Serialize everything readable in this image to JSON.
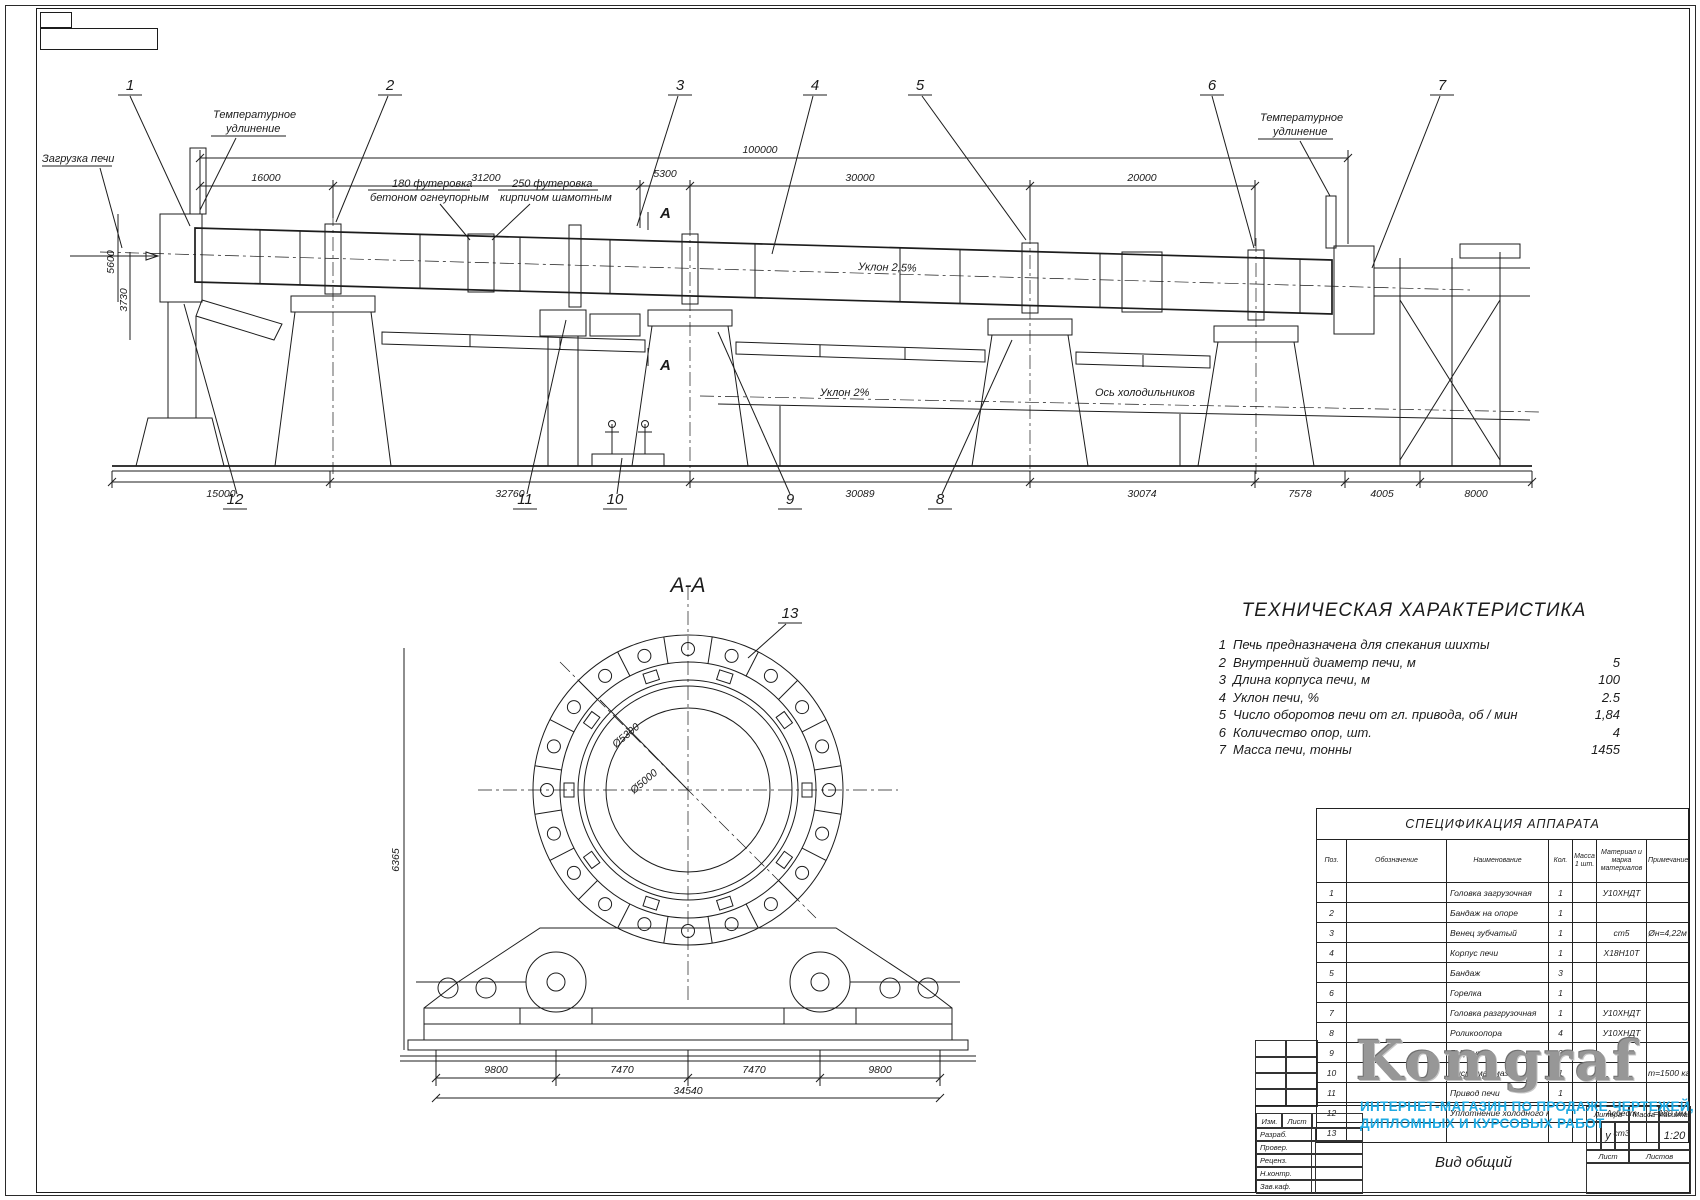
{
  "page": {
    "bg": "#ffffff",
    "line_color": "#1c1c1c"
  },
  "drawing": {
    "labels": {
      "zagruzka": "Загрузка печи",
      "temp1": "Температурное",
      "temp2": "удлинение",
      "f180a": "180 футеровка",
      "f180b": "бетоном огнеупорным",
      "f250a": "250 футеровка",
      "f250b": "кирпичом шамотным",
      "uklon_shell": "Уклон 2,5%",
      "uklon2": "Уклон 2%",
      "os_holod": "Ось холодильников",
      "sec": "А",
      "sec_title": "А-А"
    },
    "balloons": {
      "b1": "1",
      "b2": "2",
      "b3": "3",
      "b4": "4",
      "b5": "5",
      "b6": "6",
      "b7": "7",
      "b8": "8",
      "b9": "9",
      "b10": "10",
      "b11": "11",
      "b12": "12",
      "b13": "13"
    },
    "dims": {
      "top_total": "100000",
      "t1": "16000",
      "t2": "31200",
      "t3": "5300",
      "t4": "30000",
      "t5": "20000",
      "b1": "15000",
      "b2": "32760",
      "b3": "30089",
      "b4": "30074",
      "b5": "7578",
      "b6": "4005",
      "b7": "8000",
      "v1": "5600",
      "v2": "3730",
      "s1": "9800",
      "s2": "7470",
      "s3": "7470",
      "s4": "9800",
      "s_total": "34540",
      "s_v": "6365",
      "dia1": "Ø5300",
      "dia2": "Ø5000"
    }
  },
  "tech": {
    "title": "ТЕХНИЧЕСКАЯ ХАРАКТЕРИСТИКА",
    "items": [
      {
        "n": "1",
        "label": "Печь предназначена для спекания шихты",
        "value": ""
      },
      {
        "n": "2",
        "label": "Внутренний диаметр печи, м",
        "value": "5"
      },
      {
        "n": "3",
        "label": "Длина корпуса печи, м",
        "value": "100"
      },
      {
        "n": "4",
        "label": "Уклон печи, %",
        "value": "2.5"
      },
      {
        "n": "5",
        "label": "Число оборотов печи от гл. привода, об / мин",
        "value": "1,84"
      },
      {
        "n": "6",
        "label": "Количество опор, шт.",
        "value": "4"
      },
      {
        "n": "7",
        "label": "Масса печи, тонны",
        "value": "1455"
      }
    ]
  },
  "spec": {
    "title": "СПЕЦИФИКАЦИЯ АППАРАТА",
    "headers": {
      "pos": "Поз.",
      "oboz": "Обозначение",
      "name": "Наименование",
      "qty": "Кол.",
      "mass": "Масса 1 шт.",
      "mat": "Материал и марка материалов",
      "note": "Примечание"
    },
    "rows": [
      {
        "pos": "1",
        "name": "Головка загрузочная",
        "qty": "1",
        "mat": "У10ХНДТ",
        "note": ""
      },
      {
        "pos": "2",
        "name": "Бандаж на опоре",
        "qty": "1",
        "mat": "",
        "note": ""
      },
      {
        "pos": "3",
        "name": "Венец зубчатый",
        "qty": "1",
        "mat": "ст5",
        "note": "Øн=4,22м"
      },
      {
        "pos": "4",
        "name": "Корпус печи",
        "qty": "1",
        "mat": "Х18Н10Т",
        "note": ""
      },
      {
        "pos": "5",
        "name": "Бандаж",
        "qty": "3",
        "mat": "",
        "note": ""
      },
      {
        "pos": "6",
        "name": "Горелка",
        "qty": "1",
        "mat": "",
        "note": ""
      },
      {
        "pos": "7",
        "name": "Головка разгрузочная",
        "qty": "1",
        "mat": "У10ХНДТ",
        "note": ""
      },
      {
        "pos": "8",
        "name": "Роликоопора",
        "qty": "4",
        "mat": "У10ХНДТ",
        "note": ""
      },
      {
        "pos": "9",
        "name": "Гидроупор",
        "qty": "2",
        "mat": "",
        "note": ""
      },
      {
        "pos": "10",
        "name": "Система смазки",
        "qty": "1",
        "mat": "",
        "note": "m=1500 кг"
      },
      {
        "pos": "11",
        "name": "Привод печи",
        "qty": "1",
        "mat": "",
        "note": ""
      },
      {
        "pos": "12",
        "name": "Уплотнение холодного конца печи",
        "qty": "",
        "mat": "Асбест",
        "note": "L=180 мм"
      },
      {
        "pos": "13",
        "name": "",
        "qty": "",
        "mat": "ст3",
        "note": ""
      }
    ]
  },
  "logo": {
    "text": "Komgraf",
    "tagline1": "ИНТЕРНЕТ-МАГАЗИН ПО ПРОДАЖЕ ЧЕРТЕЖЕЙ,",
    "tagline2": "ДИПЛОМНЫХ И КУРСОВЫХ РАБОТ",
    "gray": "#979797",
    "blue": "#1ea9e2"
  },
  "title_block": {
    "izm": "Изм.",
    "list_small": "Лист",
    "rows": [
      "Разраб.",
      "Провер.",
      "Реценз.",
      "Н.контр.",
      "Зав.каф."
    ],
    "litera": "Литера",
    "massa": "Масса",
    "masshtab": "Масштаб",
    "litera_value": "у",
    "scale": "1:20",
    "list": "Лист",
    "listov": "Листов",
    "doc_title": "Вид общий"
  }
}
